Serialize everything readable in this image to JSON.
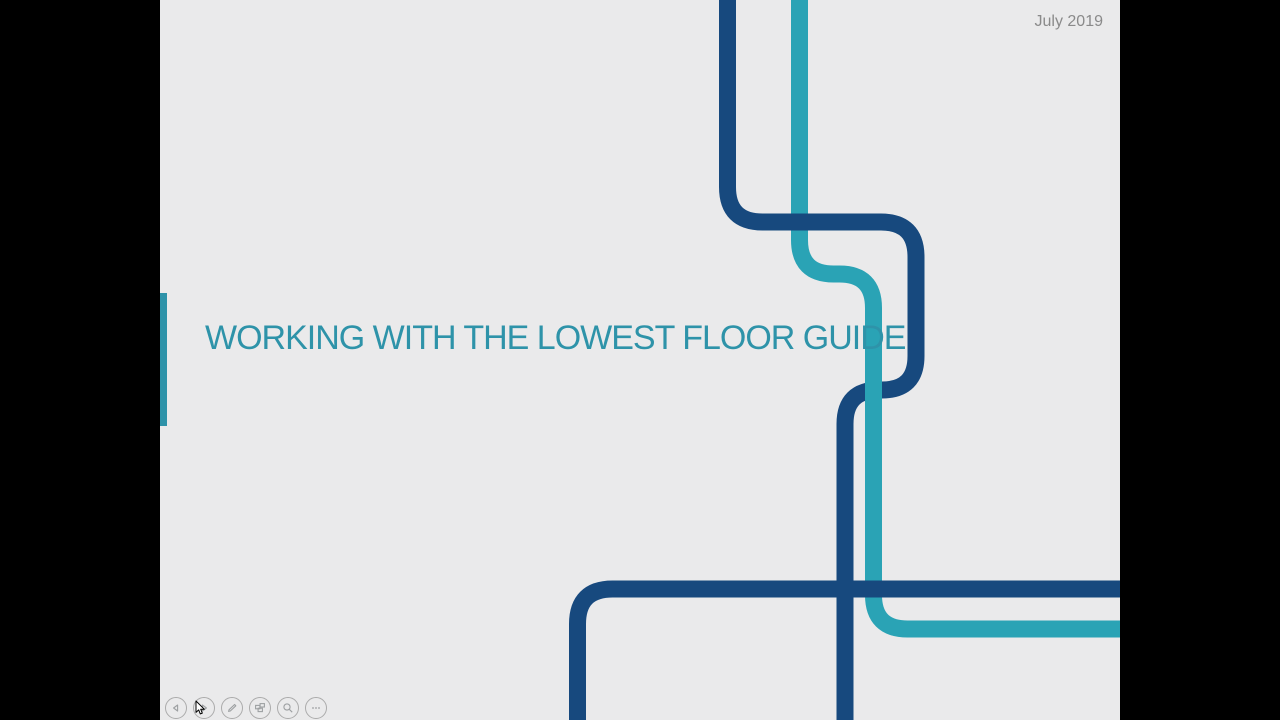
{
  "slide": {
    "title": "WORKING WITH THE LOWEST FLOOR GUIDE",
    "date": "July 2019"
  },
  "toolbar": {
    "buttons": [
      "previous-arrow-icon",
      "next-arrow-icon",
      "pen-icon",
      "see-all-slides-icon",
      "magnifier-icon",
      "more-options-icon"
    ]
  },
  "decoration": {
    "description": "three rounded metro-style pipe lines, two dark blue and one teal, entering from top and bottom-right of slide"
  },
  "colors": {
    "pipe-dark": "#17497E",
    "pipe-teal": "#2AA3B5",
    "title-teal": "#2E93A9",
    "date-gray": "#8A8A8A",
    "slide-bg": "#EAEAEB",
    "letterbox": "#000000",
    "control-gray": "#ABABAB"
  }
}
